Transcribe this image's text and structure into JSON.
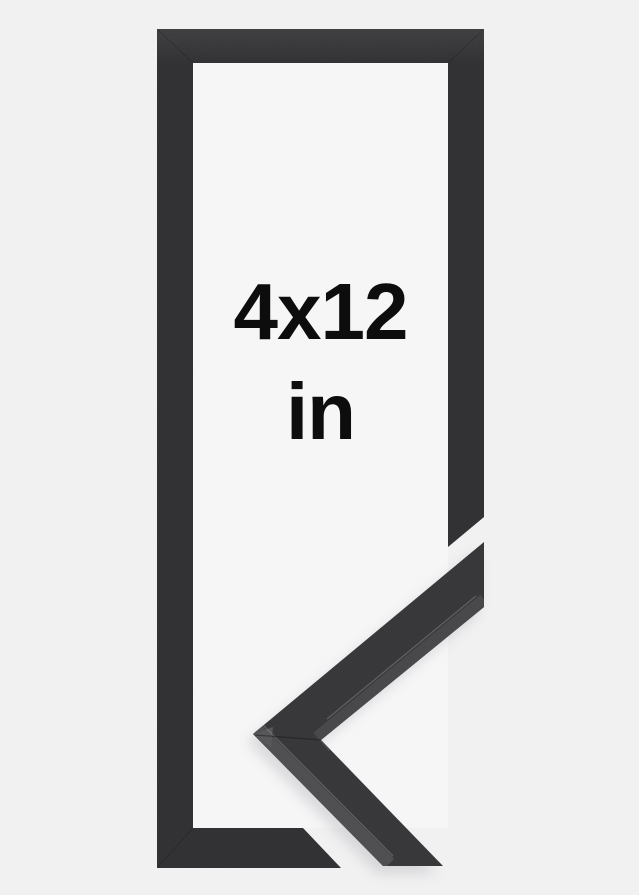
{
  "product_image": {
    "size_label": "4x12",
    "unit_label": "in",
    "description": "Black picture frame, front view, with mitered corner profile sample at lower right"
  },
  "colors": {
    "background": "#f1f1f2",
    "frame": "#2e2e30",
    "opening": "#f6f6f7",
    "sample_top_face": "#343437",
    "sample_inner_side_face": "#454548",
    "sample_outer_side_face": "#4c4c4f",
    "sample_tip_facet": "#545457",
    "text": "#0d0d0d"
  }
}
